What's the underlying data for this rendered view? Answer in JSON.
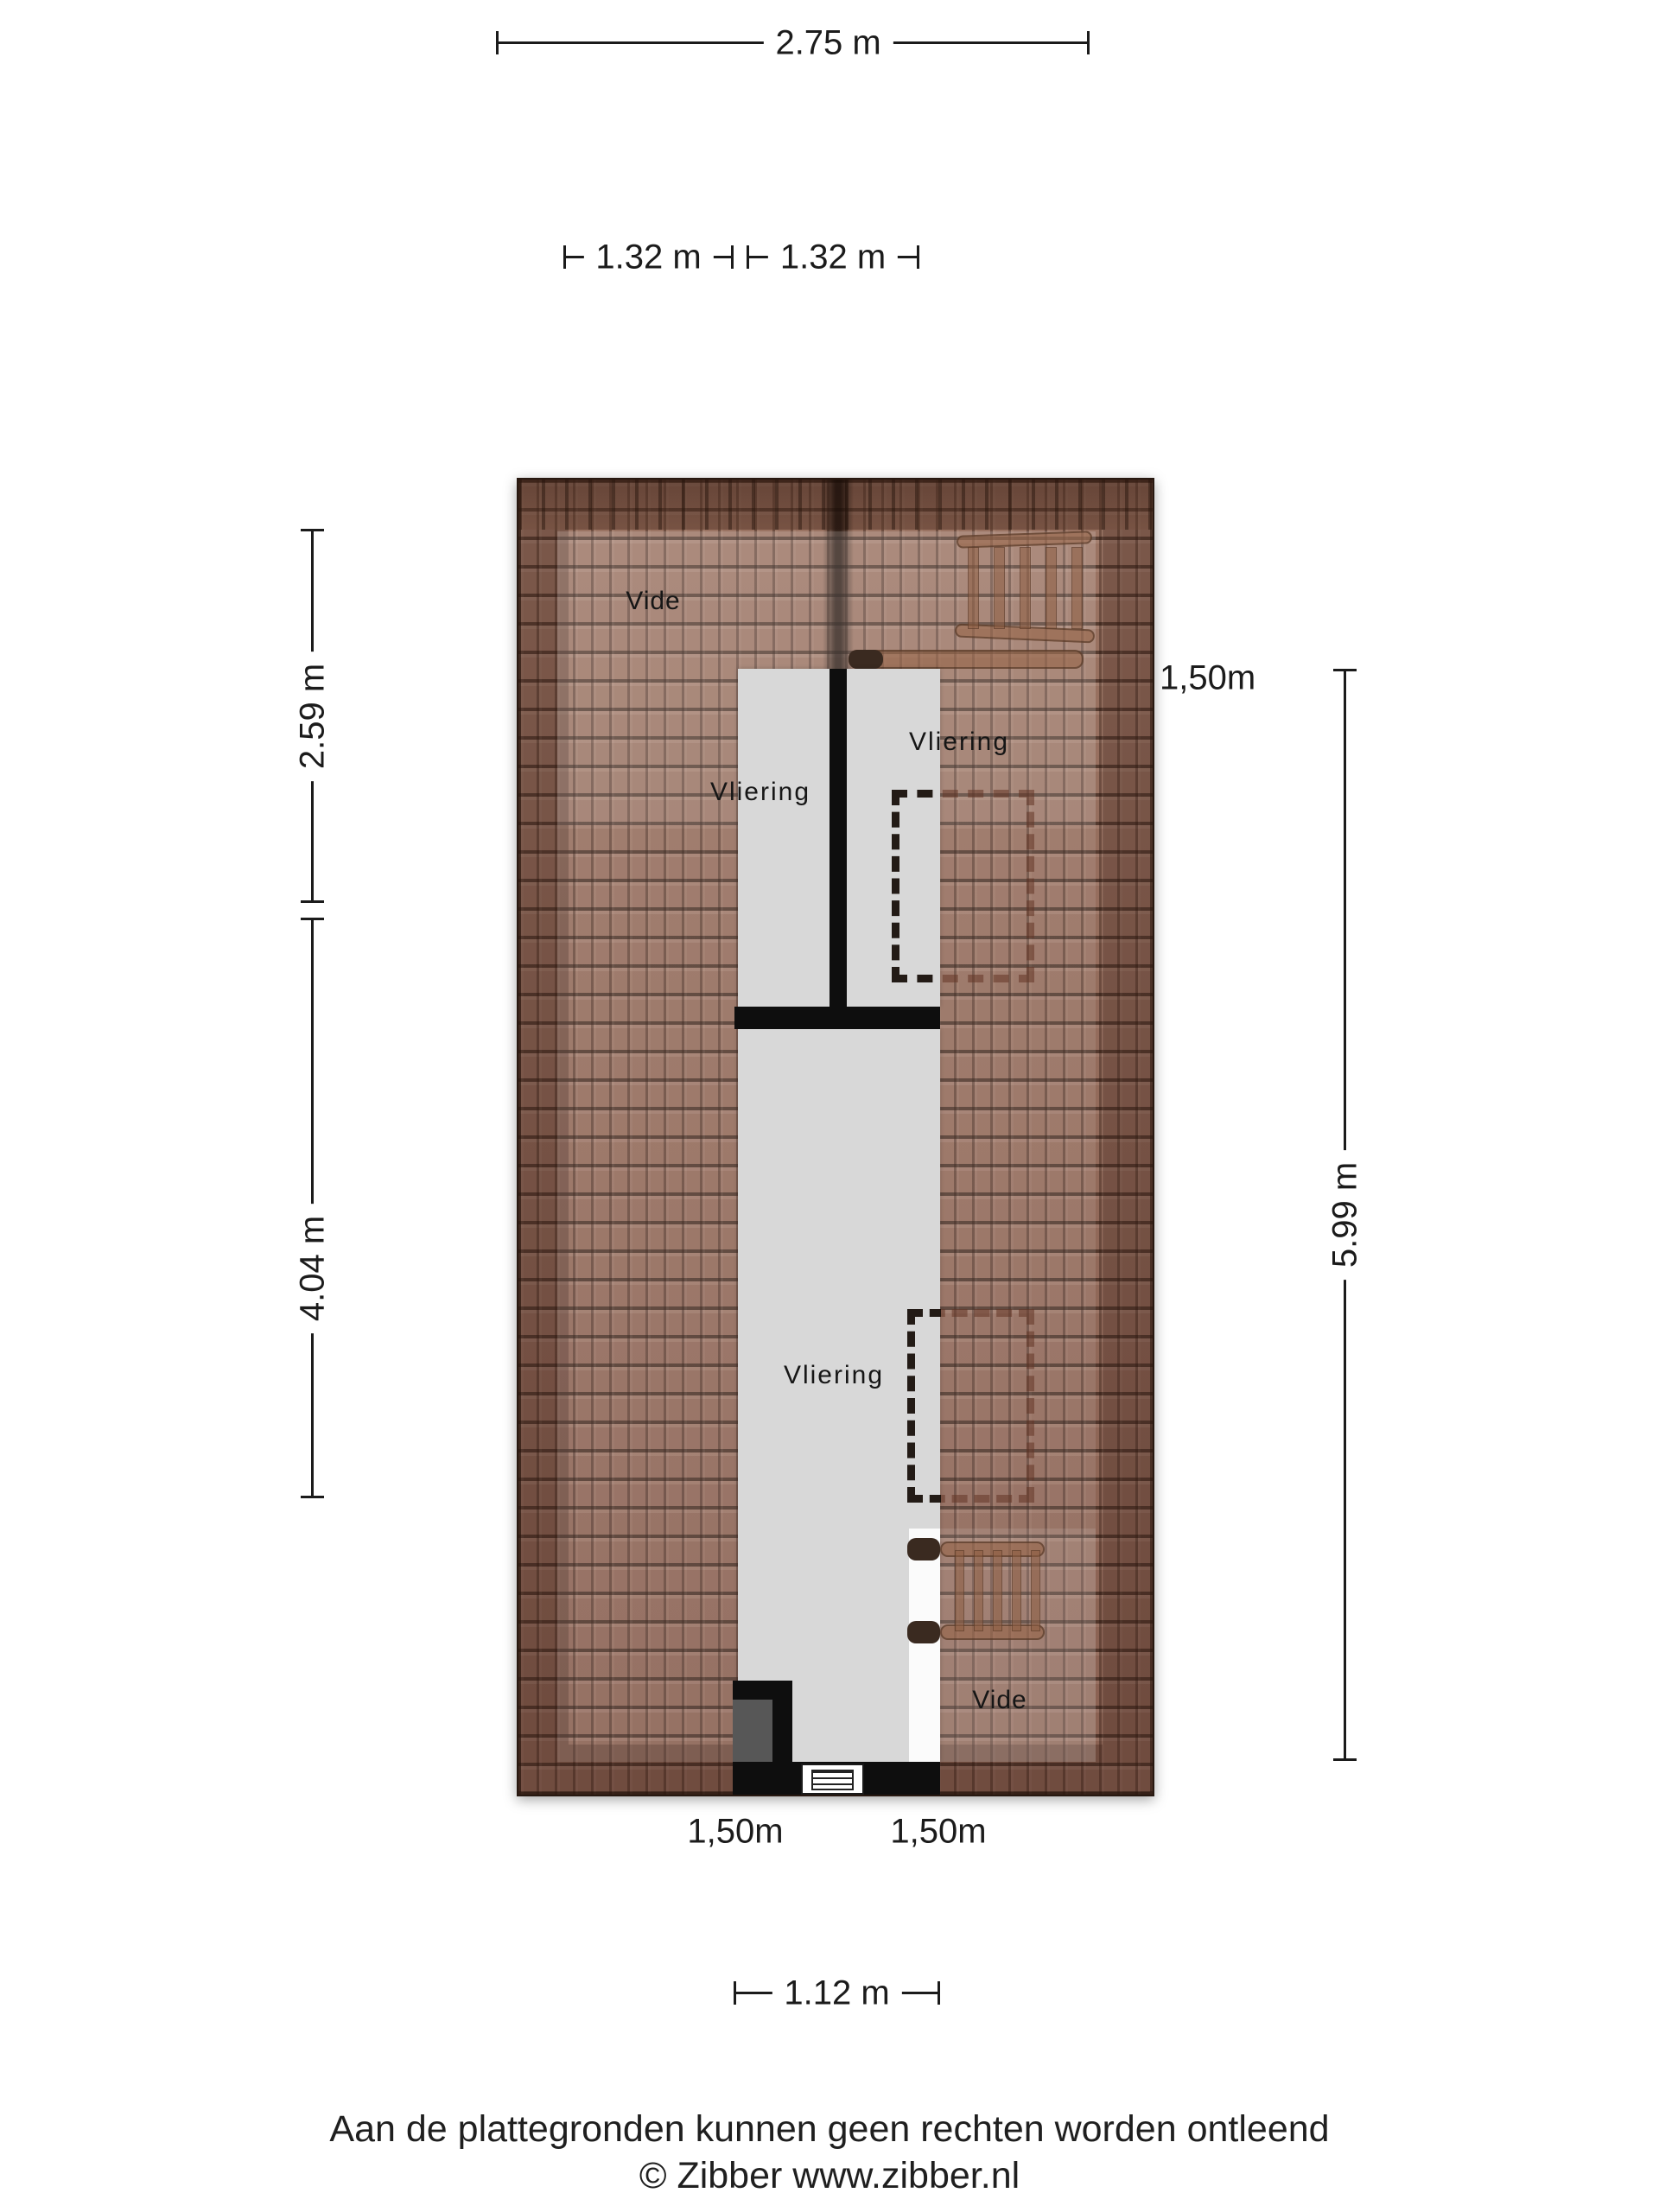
{
  "plan": {
    "rooms": {
      "vide_top": "Vide",
      "vliering_upper_left": "Vliering",
      "vliering_upper_right": "Vliering",
      "vliering_lower": "Vliering",
      "vide_bottom": "Vide"
    }
  },
  "dimensions": {
    "width_total": "2.75 m",
    "width_left_half": "1.32 m",
    "width_right_half": "1.32 m",
    "height_upper": "2.59 m",
    "height_lower": "4.04 m",
    "height_total": "5.99 m",
    "headroom_right": "1,50m",
    "headroom_bottom_left": "1,50m",
    "headroom_bottom_right": "1,50m",
    "width_bottom": "1.12 m"
  },
  "footer": {
    "disclaimer": "Aan de plattegronden kunnen geen rechten worden ontleend",
    "copyright": "© Zibber www.zibber.nl"
  },
  "colors": {
    "roof-base": "#96705f",
    "floor-gray": "#d8d8d8",
    "wall-black": "#0e0e0e",
    "hatch-white": "#fbfbfb",
    "chimney-gray": "#575757",
    "ink": "#1b1b1b"
  }
}
